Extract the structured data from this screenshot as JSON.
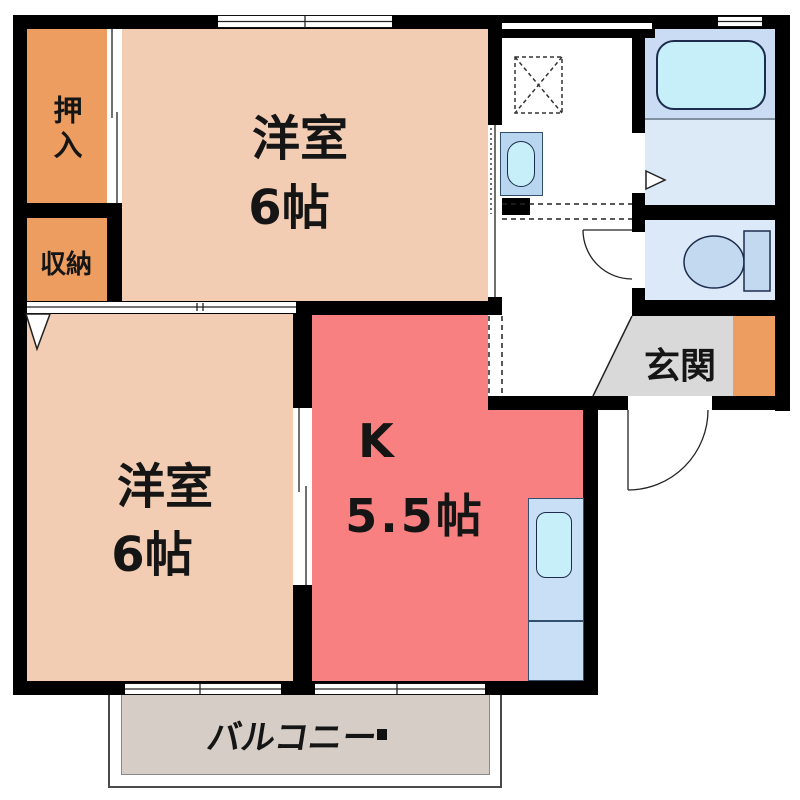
{
  "floorplan": {
    "type": "japanese-apartment-2K",
    "rooms": {
      "western_room_top": {
        "label": "洋室",
        "size": "6帖"
      },
      "western_room_bottom": {
        "label": "洋室",
        "size": "6帖"
      },
      "kitchen": {
        "label": "K",
        "size": "5.5帖"
      },
      "entrance": {
        "label": "玄関"
      },
      "balcony": {
        "label": "バルコニー"
      },
      "oshiire_closet": {
        "label": "押入"
      },
      "storage_closet": {
        "label": "収納"
      }
    },
    "fixtures": [
      "bathtub",
      "washing-machine-pan",
      "washbasin",
      "toilet",
      "kitchen-sink",
      "entrance-door-swing",
      "toilet-door-swing",
      "sliding-doors",
      "balcony-windows"
    ],
    "colors": {
      "wall": "#000000",
      "room_floor": "#F2CDB3",
      "closet": "#EC9D5F",
      "kitchen_floor": "#F98080",
      "bath_upper_floor": "#C9DCF4",
      "bath_lower_floor": "#DCEAF8",
      "toilet_floor": "#DBE9F8",
      "fixture_cyan": "#C6EFF9",
      "fixture_blue": "#C9DFF5",
      "entrance_floor": "#D9D9D9",
      "balcony_floor": "#D5CDC6"
    }
  }
}
